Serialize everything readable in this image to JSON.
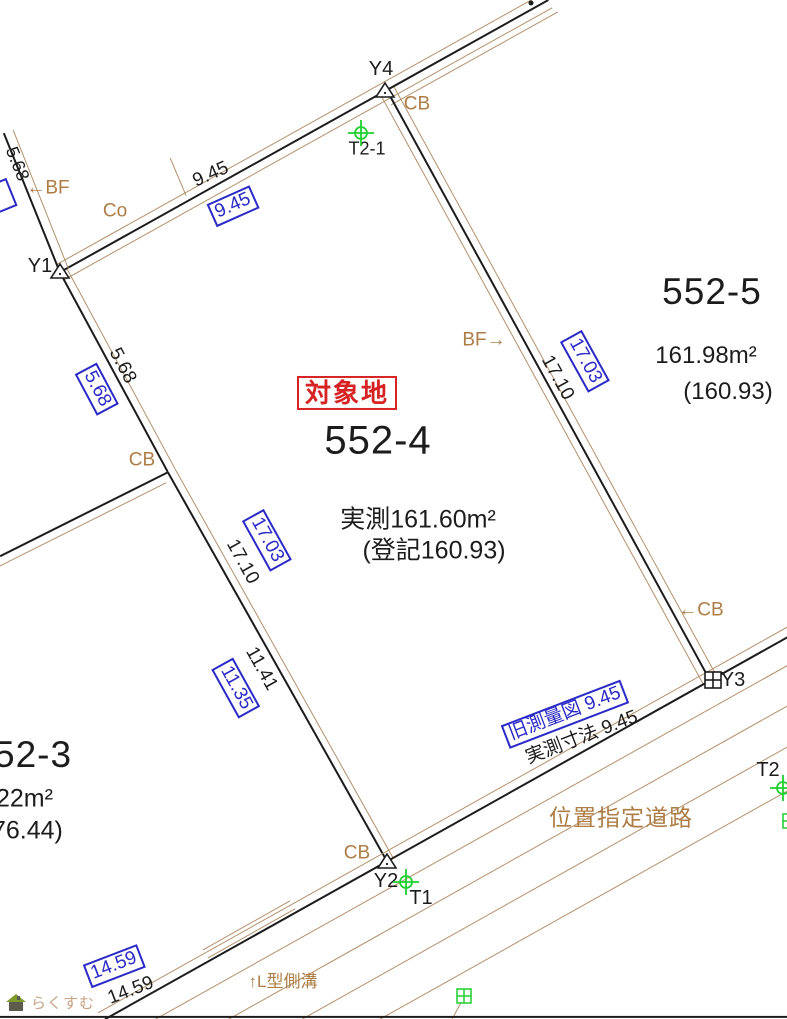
{
  "map": {
    "colors": {
      "black": "#1c1c1c",
      "brown": "#b3906a",
      "text_brown": "#ad7d45",
      "blue": "#2a2ac8",
      "red": "#d62222",
      "green": "#1fcf2f"
    },
    "watermark": {
      "text": "らくすむ"
    },
    "lines": [
      {
        "name": "road-top-black",
        "x1": 60,
        "y1": 272,
        "x2": 548,
        "y2": 0,
        "c": "black",
        "w": 1.6
      },
      {
        "name": "road-top-brown-upper",
        "x1": 56,
        "y1": 265,
        "x2": 544,
        "y2": -7,
        "c": "brown",
        "w": 1.2
      },
      {
        "name": "road-top-brown-lower",
        "x1": 64,
        "y1": 280,
        "x2": 552,
        "y2": 8,
        "c": "brown",
        "w": 1.2
      },
      {
        "name": "road-top-brown-lower2",
        "x1": 391,
        "y1": 105,
        "x2": 558,
        "y2": 12,
        "c": "brown",
        "w": 1.2
      },
      {
        "name": "fence-tick",
        "x1": 170,
        "y1": 158,
        "x2": 186,
        "y2": 196,
        "c": "brown",
        "w": 1.4
      },
      {
        "name": "upper-left-boundary-black",
        "x1": 4,
        "y1": 133,
        "x2": 60,
        "y2": 272,
        "c": "black",
        "w": 1.6
      },
      {
        "name": "upper-left-boundary-brown",
        "x1": 13,
        "y1": 130,
        "x2": 68,
        "y2": 268,
        "c": "brown",
        "w": 1.2
      },
      {
        "name": "west-boundary-black-1",
        "x1": 60,
        "y1": 272,
        "x2": 168,
        "y2": 472,
        "c": "black",
        "w": 1.6
      },
      {
        "name": "west-boundary-brown-1",
        "x1": 67,
        "y1": 269,
        "x2": 175,
        "y2": 469,
        "c": "brown",
        "w": 1.2
      },
      {
        "name": "west-boundary-black-2",
        "x1": 168,
        "y1": 472,
        "x2": 387,
        "y2": 861,
        "c": "black",
        "w": 1.6
      },
      {
        "name": "west-boundary-brown-2",
        "x1": 175,
        "y1": 469,
        "x2": 393,
        "y2": 858,
        "c": "brown",
        "w": 1.2
      },
      {
        "name": "branch-boundary-black",
        "x1": 0,
        "y1": 556,
        "x2": 168,
        "y2": 472,
        "c": "black",
        "w": 1.6
      },
      {
        "name": "branch-boundary-brown",
        "x1": 0,
        "y1": 566,
        "x2": 166,
        "y2": 483,
        "c": "brown",
        "w": 1.2
      },
      {
        "name": "east-boundary-black",
        "x1": 387,
        "y1": 90,
        "x2": 710,
        "y2": 680,
        "c": "black",
        "w": 1.6
      },
      {
        "name": "east-boundary-brown-left",
        "x1": 380,
        "y1": 94,
        "x2": 703,
        "y2": 684,
        "c": "brown",
        "w": 1.2
      },
      {
        "name": "east-boundary-brown-right",
        "x1": 394,
        "y1": 87,
        "x2": 717,
        "y2": 677,
        "c": "brown",
        "w": 1.2
      },
      {
        "name": "south-boundary-black",
        "x1": 105,
        "y1": 1019,
        "x2": 800,
        "y2": 630,
        "c": "black",
        "w": 1.6
      },
      {
        "name": "south-boundary-brown",
        "x1": 98,
        "y1": 1013,
        "x2": 793,
        "y2": 624,
        "c": "brown",
        "w": 1.2
      },
      {
        "name": "road-line-1",
        "x1": 140,
        "y1": 1028,
        "x2": 835,
        "y2": 639,
        "c": "brown",
        "w": 1.2
      },
      {
        "name": "road-line-2",
        "x1": 215,
        "y1": 1027,
        "x2": 800,
        "y2": 699,
        "c": "brown",
        "w": 1.2
      },
      {
        "name": "road-line-3",
        "x1": 292,
        "y1": 1025,
        "x2": 800,
        "y2": 740,
        "c": "brown",
        "w": 1.2
      },
      {
        "name": "road-line-4",
        "x1": 368,
        "y1": 1026,
        "x2": 800,
        "y2": 784,
        "c": "brown",
        "w": 1.2
      },
      {
        "name": "pole-stub",
        "x1": 461,
        "y1": 1002,
        "x2": 452,
        "y2": 1019,
        "c": "brown",
        "w": 1.4
      },
      {
        "name": "gutter-line-1",
        "x1": 203,
        "y1": 950,
        "x2": 290,
        "y2": 901,
        "c": "brown",
        "w": 1.2
      },
      {
        "name": "gutter-line-2",
        "x1": 208,
        "y1": 958,
        "x2": 295,
        "y2": 909,
        "c": "brown",
        "w": 1.2
      },
      {
        "name": "bottom-frame",
        "x1": 0,
        "y1": 1017,
        "x2": 787,
        "y2": 1017,
        "c": "black",
        "w": 2.2
      }
    ],
    "labels": [
      {
        "name": "point-label-y4",
        "text": "Y4",
        "x": 381,
        "y": 70,
        "rot": 0,
        "cls": "",
        "size": 20
      },
      {
        "name": "wall-label-cb-top",
        "text": "CB",
        "x": 417,
        "y": 105,
        "rot": 0,
        "cls": "c-brown",
        "size": 19
      },
      {
        "name": "point-label-t2-1",
        "text": "T2-1",
        "x": 367,
        "y": 149,
        "rot": 0,
        "cls": "",
        "size": 18
      },
      {
        "name": "dim-5-68-upper",
        "text": "5.68",
        "x": 17,
        "y": 164,
        "rot": 68,
        "cls": "",
        "size": 18
      },
      {
        "name": "wall-label-bf-left",
        "text": "←BF",
        "x": 48,
        "y": 189,
        "rot": 0,
        "cls": "c-brown",
        "size": 19
      },
      {
        "name": "wall-label-co",
        "text": "Co",
        "x": 115,
        "y": 212,
        "rot": 0,
        "cls": "c-brown",
        "size": 19
      },
      {
        "name": "dim-9-45-top",
        "text": "9.45",
        "x": 211,
        "y": 175,
        "rot": -24,
        "cls": "",
        "size": 19
      },
      {
        "name": "dim-9-45-top-boxed",
        "text": "9.45",
        "x": 233,
        "y": 206,
        "rot": -24,
        "cls": "bx-blue",
        "size": 19
      },
      {
        "name": "point-label-y1",
        "text": "Y1",
        "x": 40,
        "y": 267,
        "rot": 0,
        "cls": "",
        "size": 20
      },
      {
        "name": "dim-5-68-west",
        "text": "5.68",
        "x": 122,
        "y": 366,
        "rot": 62,
        "cls": "",
        "size": 19
      },
      {
        "name": "dim-5-68-west-boxed",
        "text": "5.68",
        "x": 97,
        "y": 389,
        "rot": 62,
        "cls": "bx-blue",
        "size": 19
      },
      {
        "name": "wall-label-cb-west",
        "text": "CB",
        "x": 142,
        "y": 461,
        "rot": 0,
        "cls": "c-brown",
        "size": 19
      },
      {
        "name": "subject-land-tag",
        "text": "対象地",
        "x": 347,
        "y": 393,
        "rot": 0,
        "cls": "bx-red",
        "size": 26
      },
      {
        "name": "subject-parcel-number",
        "text": "552-4",
        "x": 378,
        "y": 441,
        "rot": 0,
        "cls": "big",
        "size": 40
      },
      {
        "name": "subject-measured-area",
        "text": "実測161.60m²",
        "x": 418,
        "y": 520,
        "rot": 0,
        "cls": "",
        "size": 25
      },
      {
        "name": "subject-registered-area",
        "text": "(登記160.93)",
        "x": 434,
        "y": 551,
        "rot": 0,
        "cls": "",
        "size": 25
      },
      {
        "name": "wall-label-bf-right",
        "text": "BF→",
        "x": 484,
        "y": 341,
        "rot": 0,
        "cls": "c-brown",
        "size": 19
      },
      {
        "name": "dim-17-03-east-boxed",
        "text": "17.03",
        "x": 585,
        "y": 361,
        "rot": 61,
        "cls": "bx-blue",
        "size": 19
      },
      {
        "name": "dim-17-10-east",
        "text": "17.10",
        "x": 557,
        "y": 378,
        "rot": 61,
        "cls": "",
        "size": 19
      },
      {
        "name": "parcel-552-5-number",
        "text": "552-5",
        "x": 712,
        "y": 292,
        "rot": 0,
        "cls": "big",
        "size": 37
      },
      {
        "name": "parcel-552-5-area",
        "text": "161.98m²",
        "x": 706,
        "y": 356,
        "rot": 0,
        "cls": "",
        "size": 24
      },
      {
        "name": "parcel-552-5-registered",
        "text": "(160.93)",
        "x": 728,
        "y": 392,
        "rot": 0,
        "cls": "",
        "size": 24
      },
      {
        "name": "wall-label-cb-east",
        "text": "←CB",
        "x": 701,
        "y": 611,
        "rot": 0,
        "cls": "c-brown",
        "size": 19
      },
      {
        "name": "point-label-y3",
        "text": "Y3",
        "x": 733,
        "y": 681,
        "rot": 0,
        "cls": "",
        "size": 20
      },
      {
        "name": "dim-17-03-west-boxed",
        "text": "17.03",
        "x": 267,
        "y": 540,
        "rot": 61,
        "cls": "bx-blue",
        "size": 19
      },
      {
        "name": "dim-17-10-west",
        "text": "17.10",
        "x": 242,
        "y": 562,
        "rot": 61,
        "cls": "",
        "size": 19
      },
      {
        "name": "dim-11-41",
        "text": "11.41",
        "x": 261,
        "y": 669,
        "rot": 61,
        "cls": "",
        "size": 19
      },
      {
        "name": "dim-11-35-boxed",
        "text": "11.35",
        "x": 236,
        "y": 688,
        "rot": 61,
        "cls": "bx-blue",
        "size": 19
      },
      {
        "name": "old-survey-note-boxed",
        "text": "旧測量図 9.45",
        "x": 565,
        "y": 714,
        "rot": -21,
        "cls": "bx-blue",
        "size": 19
      },
      {
        "name": "measured-dim-note",
        "text": "実測寸法 9.45",
        "x": 582,
        "y": 738,
        "rot": -21,
        "cls": "",
        "size": 19
      },
      {
        "name": "road-name",
        "text": "位置指定道路",
        "x": 621,
        "y": 818,
        "rot": 0,
        "cls": "c-brown big",
        "size": 23
      },
      {
        "name": "parcel-552-3-number",
        "text": "52-3",
        "x": -6,
        "y": 755,
        "rot": 0,
        "cls": "big",
        "size": 37,
        "align": "left"
      },
      {
        "name": "parcel-552-3-area",
        "text": "22m²",
        "x": -4,
        "y": 799,
        "rot": 0,
        "cls": "",
        "size": 25,
        "align": "left"
      },
      {
        "name": "parcel-552-3-registered",
        "text": "76.44)",
        "x": -8,
        "y": 831,
        "rot": 0,
        "cls": "",
        "size": 25,
        "align": "left"
      },
      {
        "name": "wall-label-cb-south",
        "text": "CB",
        "x": 357,
        "y": 854,
        "rot": 0,
        "cls": "c-brown",
        "size": 19
      },
      {
        "name": "point-label-y2",
        "text": "Y2",
        "x": 386,
        "y": 882,
        "rot": 0,
        "cls": "",
        "size": 20
      },
      {
        "name": "point-label-t1",
        "text": "T1",
        "x": 421,
        "y": 899,
        "rot": 0,
        "cls": "",
        "size": 20
      },
      {
        "name": "point-label-t2",
        "text": "T2",
        "x": 768,
        "y": 771,
        "rot": 0,
        "cls": "",
        "size": 20
      },
      {
        "name": "dim-14-59-boxed",
        "text": "14.59",
        "x": 114,
        "y": 966,
        "rot": -21,
        "cls": "bx-blue",
        "size": 19
      },
      {
        "name": "dim-14-59",
        "text": "14.59",
        "x": 131,
        "y": 991,
        "rot": -21,
        "cls": "",
        "size": 19
      },
      {
        "name": "gutter-note",
        "text": "↑L型側溝",
        "x": 283,
        "y": 982,
        "rot": 0,
        "cls": "c-brown",
        "size": 17
      },
      {
        "name": "edge-cut-dimension-box",
        "text": "",
        "x": -1,
        "y": 197,
        "rot": 68,
        "cls": "bx-blue empty-box",
        "size": 19
      }
    ],
    "markers": [
      {
        "name": "survey-point-y4-triangle",
        "type": "triangle",
        "x": 385,
        "y": 90
      },
      {
        "name": "survey-point-y1-triangle",
        "type": "triangle",
        "x": 60,
        "y": 271
      },
      {
        "name": "survey-point-y2-triangle",
        "type": "triangle",
        "x": 387,
        "y": 861
      },
      {
        "name": "survey-point-y3-square",
        "type": "square-cross",
        "x": 713,
        "y": 680
      },
      {
        "name": "survey-point-t2-1-cross",
        "type": "cross-circle",
        "x": 361,
        "y": 133
      },
      {
        "name": "survey-point-t1-cross",
        "type": "cross-circle",
        "x": 406,
        "y": 882
      },
      {
        "name": "survey-point-t2-cross",
        "type": "cross-circle",
        "x": 783,
        "y": 788
      },
      {
        "name": "utility-square-green",
        "type": "square-cross-green",
        "x": 464,
        "y": 996
      },
      {
        "name": "utility-square-green-edge",
        "type": "square-cross-green",
        "x": 790,
        "y": 821
      },
      {
        "name": "top-edge-dot",
        "type": "dot",
        "x": 531,
        "y": 3
      }
    ]
  }
}
